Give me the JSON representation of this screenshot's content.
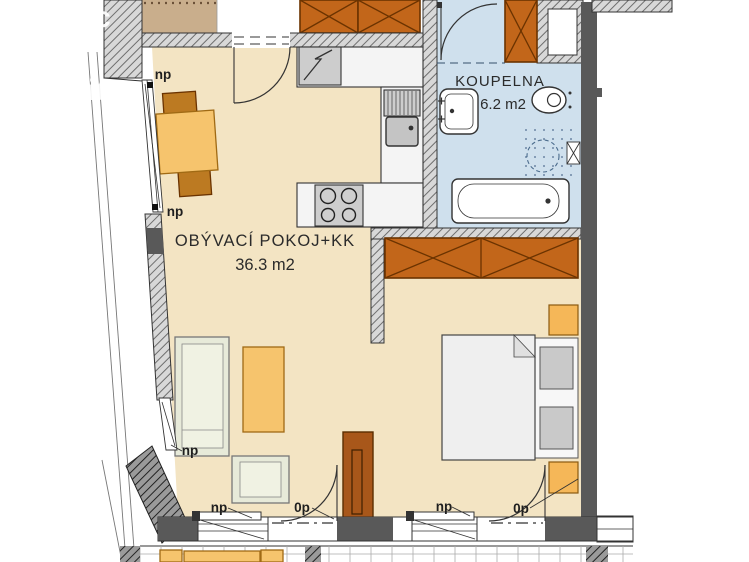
{
  "palette": {
    "floor": "#f3e4c3",
    "bath": "#cfe0ed",
    "wood": "#c2661a",
    "wood_dark": "#a8571a",
    "wall_dark": "#595959",
    "tbl": "#f6c46d",
    "chair": "#bc7a22",
    "sofa": "#e7ead9",
    "tan": "#c9ae8c",
    "nstand": "#f5b758"
  },
  "watermark": {
    "frag1": "c",
    "frag2": "it"
  },
  "rooms": {
    "living": {
      "name": "OBÝVACÍ POKOJ+KK",
      "area": "36.3 m2"
    },
    "bathroom": {
      "name": "KOUPELNA",
      "area": "6.2 m2"
    }
  },
  "labels": {
    "np_dining_top": "np",
    "np_dining_bottom": "np",
    "np_left_lower": "np",
    "np_living_window": "np",
    "op_living_door": "0p",
    "np_bedroom_window": "np",
    "op_bedroom_door": "0p"
  }
}
